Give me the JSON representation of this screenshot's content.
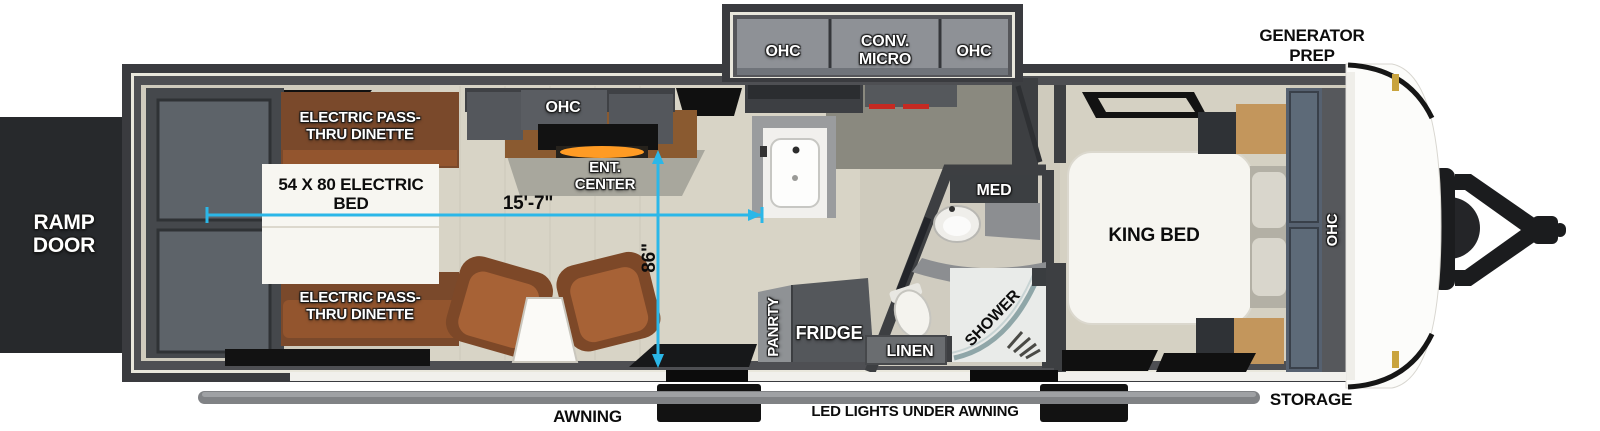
{
  "exterior": {
    "ramp_door": "RAMP DOOR",
    "generator_prep": "GENERATOR PREP",
    "awning": "AWNING",
    "led_lights": "LED LIGHTS UNDER AWNING",
    "storage": "STORAGE"
  },
  "kitchen": {
    "ohc_left": "OHC",
    "conv_micro": "CONV. MICRO",
    "ohc_right": "OHC",
    "pantry": "PANRTY",
    "fridge": "FRIDGE"
  },
  "living_area": {
    "dinette_top": "ELECTRIC PASS-THRU DINETTE",
    "dinette_bottom": "ELECTRIC PASS-THRU DINETTE",
    "electric_bed": "54 X 80 ELECTRIC BED",
    "ohc": "OHC",
    "ent_center": "ENT. CENTER"
  },
  "bathroom": {
    "med": "MED",
    "shower": "SHOWER",
    "linen": "LINEN"
  },
  "bedroom": {
    "king_bed": "KING BED",
    "ohc": "OHC"
  },
  "dimensions": {
    "interior_length": "15'-7\"",
    "interior_height": "86\"",
    "line_color": "#2bb7e8"
  }
}
